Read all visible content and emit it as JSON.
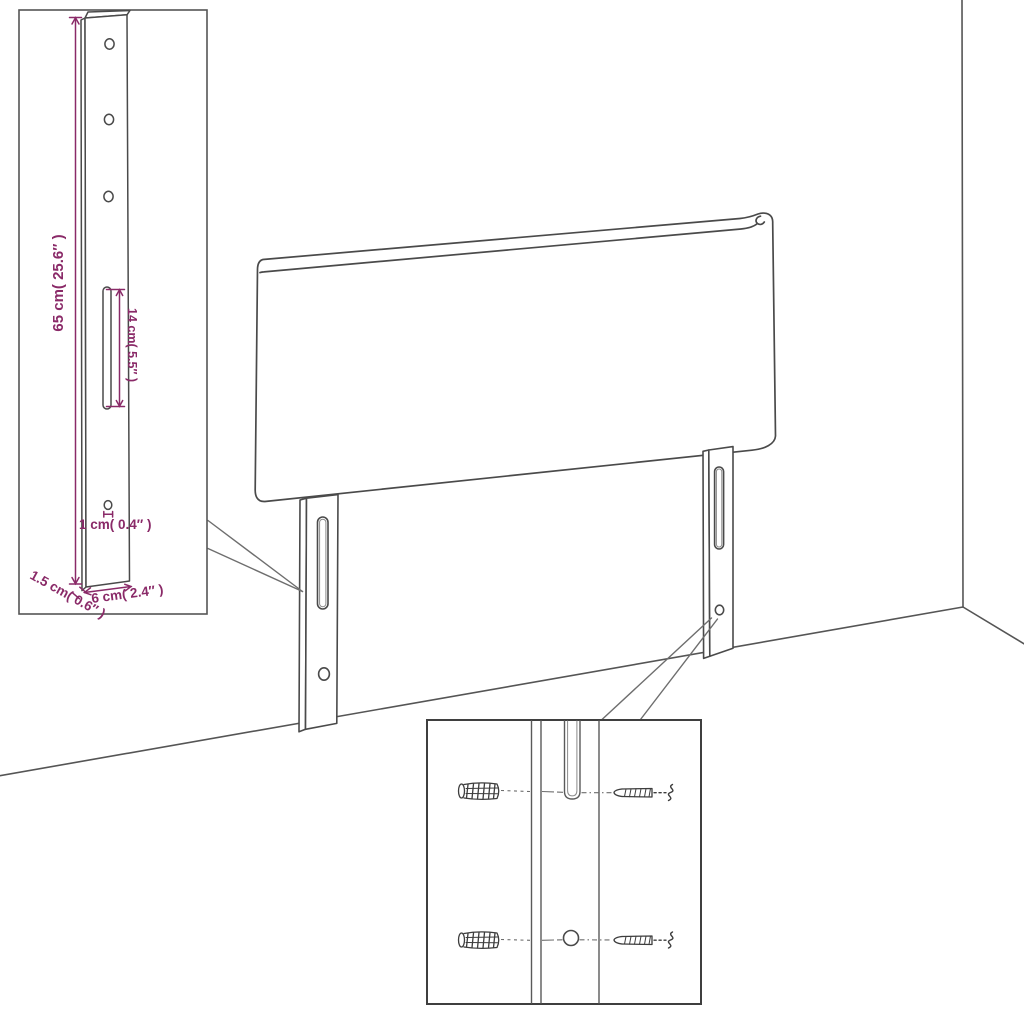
{
  "diagram": {
    "subject": "Headboard with two slotted mounting legs — dimension diagram",
    "colors": {
      "line": "#4a4a4a",
      "dimension": "#8a2a68",
      "background": "#ffffff",
      "box_border": "#3f3f3f"
    },
    "inset": {
      "dim_height": "65 cm( 25.6″ )",
      "dim_slot": "14 cm( 5.5″ )",
      "dim_hole": "1 cm( 0.4″ )",
      "dim_thickness": "1.5 cm( 0.6″ )",
      "dim_width": "6 cm( 2.4″ )"
    }
  }
}
